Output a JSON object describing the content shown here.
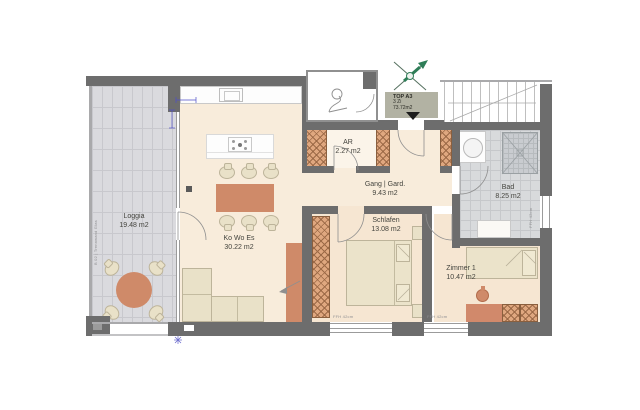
{
  "plan": {
    "unit_badge": {
      "name": "TOP A3",
      "rooms_count": "3 Zi",
      "total_area": "73.72m2"
    },
    "rooms": [
      {
        "name": "Loggia",
        "area": "19.48 m2"
      },
      {
        "name": "Ko Wo Es",
        "area": "30.22 m2"
      },
      {
        "name": "AR",
        "area": "2.27 m2"
      },
      {
        "name": "Gang | Gard.",
        "area": "9.43 m2"
      },
      {
        "name": "Schlafen",
        "area": "13.08 m2"
      },
      {
        "name": "Zimmer 1",
        "area": "10.47 m2"
      },
      {
        "name": "Bad",
        "area": "8.25 m2"
      }
    ],
    "annotations": {
      "window_sill_left": "FFH 42cm",
      "window_sill_right": "FFH 42cm",
      "window_sill_bath": "FFH 42cm",
      "loggia_partition_note": "B 02 | Trennwand Glas"
    },
    "colors": {
      "wall": "#6d6d6d",
      "floor_cream": "#f8ecdb",
      "floor_peach": "#f6e6d2",
      "terracotta": "#cf8a69",
      "furniture_beige": "#e9e1c8",
      "tile_gray": "#d8dadc",
      "shaft_hatch": "#dfa77f",
      "unit_badge_bg": "#b2b2a3",
      "compass_green": "#2e7d57",
      "dimension_blue": "#5050c8"
    }
  }
}
